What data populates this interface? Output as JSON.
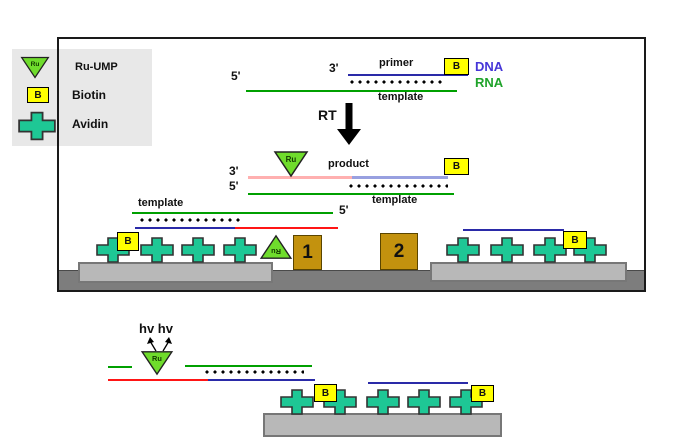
{
  "colors": {
    "rna_green": "#00a000",
    "dna_blue": "#2a2aa8",
    "product_pink": "#ffb0b0",
    "product_blue": "#98a0e0",
    "red_line": "#ff1515",
    "avidin_teal": "#1ec795",
    "ru_green": "#6fdc2c",
    "biotin_yellow": "#ffff00",
    "electrode_gold": "#c3920e",
    "platform_gray": "#b8b8b8",
    "base_gray": "#7d7d7d",
    "legend_gray": "#e8e8e8",
    "dna_text": "#4636d8",
    "rna_text": "#1fa32a"
  },
  "legend": {
    "ru_ump": "Ru-UMP",
    "biotin": "Biotin",
    "avidin": "Avidin"
  },
  "glyphs": {
    "ru": "Ru",
    "b": "B"
  },
  "labels": {
    "three_prime": "3'",
    "five_prime": "5'",
    "primer": "primer",
    "template": "template",
    "product": "product",
    "rt": "RT",
    "dna": "DNA",
    "rna": "RNA",
    "hv": "hv hv",
    "electrode_1": "1",
    "electrode_2": "2"
  }
}
